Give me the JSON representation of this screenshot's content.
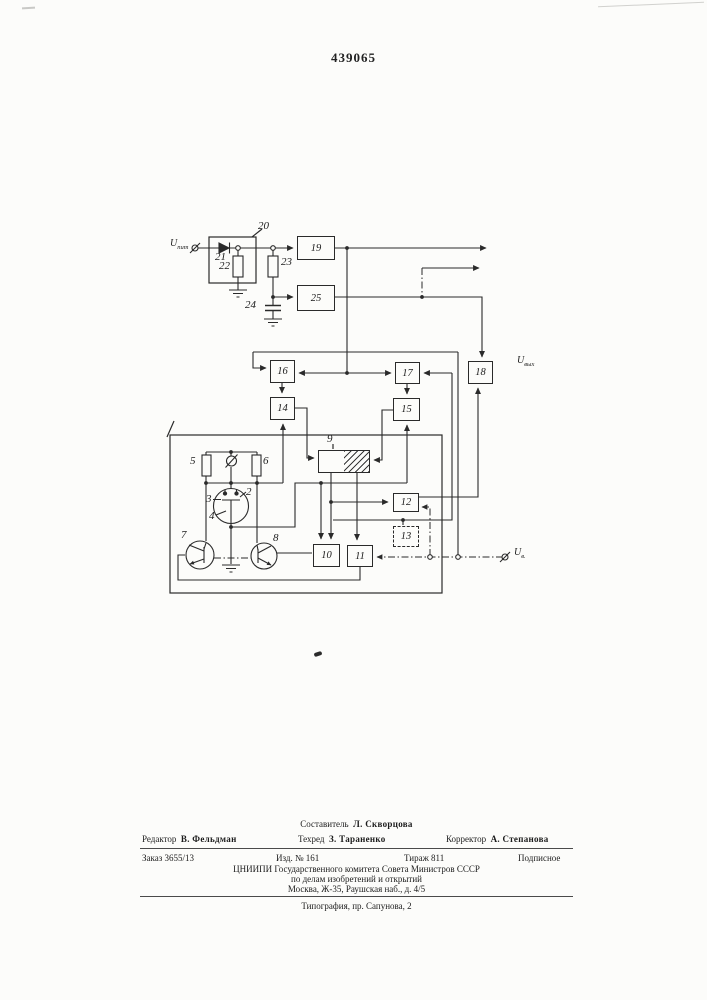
{
  "patent_number": "439065",
  "diagram": {
    "terminals": {
      "input": {
        "base": "U",
        "sub": "пит"
      },
      "output": {
        "base": "U",
        "sub": "вых"
      },
      "control": {
        "base": "U",
        "sub": "в."
      }
    },
    "blocks": {
      "b19": "19",
      "b25": "25",
      "b16": "16",
      "b17": "17",
      "b18": "18",
      "b14": "14",
      "b15": "15",
      "b9": "9",
      "b10": "10",
      "b11": "11",
      "b12": "12",
      "b13": "13"
    },
    "part_labels": {
      "n20": "20",
      "n21": "21",
      "n22": "22",
      "n23": "23",
      "n24": "24",
      "n5": "5",
      "n6": "6",
      "n2": "2",
      "n3": "3",
      "n4": "4",
      "n7": "7",
      "n8": "8"
    }
  },
  "footer": {
    "composer_role": "Составитель",
    "composer_name": "Л. Скворцова",
    "editor_role": "Редактор",
    "editor_name": "В. Фельдман",
    "techred_role": "Техред",
    "techred_name": "З. Тараненко",
    "corrector_role": "Корректор",
    "corrector_name": "А. Степанова",
    "order": "Заказ 3655/13",
    "issue": "Изд. № 161",
    "print_run": "Тираж 811",
    "subscription": "Подписное",
    "org_line1": "ЦНИИПИ Государственного комитета Совета Министров СССР",
    "org_line2": "по делам изобретений и открытий",
    "org_line3": "Москва, Ж-35, Раушская наб., д. 4/5",
    "printing_house": "Типография, пр. Сапунова, 2"
  }
}
